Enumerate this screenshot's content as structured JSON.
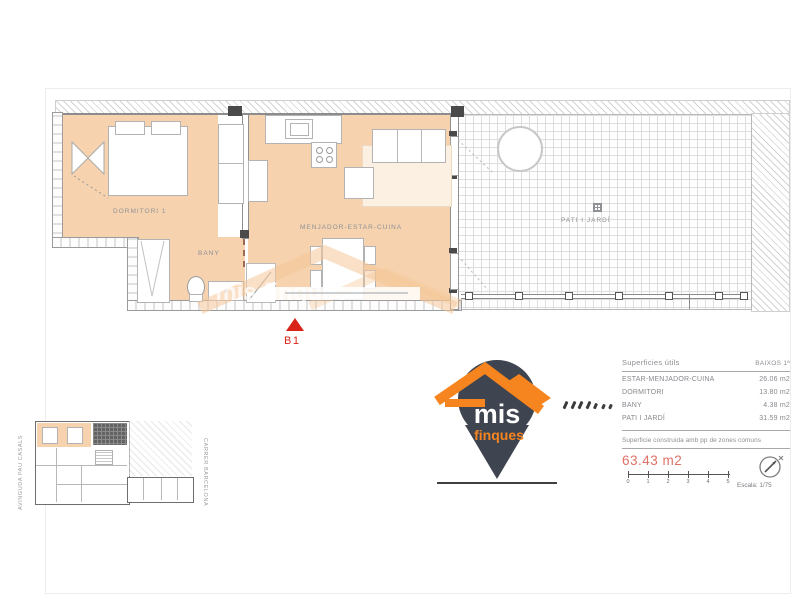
{
  "colors": {
    "floor": "#f7d2ae",
    "logo_orange": "#f6851f",
    "logo_charcoal": "#3e4450",
    "marker_red": "#d92318",
    "total_red": "#df7166"
  },
  "plan": {
    "rooms": {
      "dormitori": "DORMITORI 1",
      "bany": "BANY",
      "menjador": "MENJADOR-ESTAR-CUINA",
      "pati": "PATI I JARDÍ"
    },
    "marker_label": "B1",
    "watermark": "mis finques"
  },
  "key_plan": {
    "street_left": "AVINGUDA PAU CASALS",
    "street_right": "CARRER BARCELONA"
  },
  "logo": {
    "word1": "mis",
    "word2": "finques"
  },
  "surfaces": {
    "title": "Superficies útils",
    "column": "BAIXOS 1ª",
    "rows": [
      {
        "name": "ESTAR-MENJADOR-CUINA",
        "value": "26.06 m2"
      },
      {
        "name": "DORMITORI",
        "value": "13.80 m2"
      },
      {
        "name": "BANY",
        "value": "4.38 m2"
      },
      {
        "name": "PATI I JARDÍ",
        "value": "31.59 m2"
      }
    ],
    "built_note": "Superficie construida amb pp de zones comuns",
    "total": "63.43 m2"
  },
  "scale_bar": {
    "ticks": [
      "0",
      "1",
      "2",
      "3",
      "4",
      "5"
    ],
    "label": "Escala: 1/75"
  }
}
